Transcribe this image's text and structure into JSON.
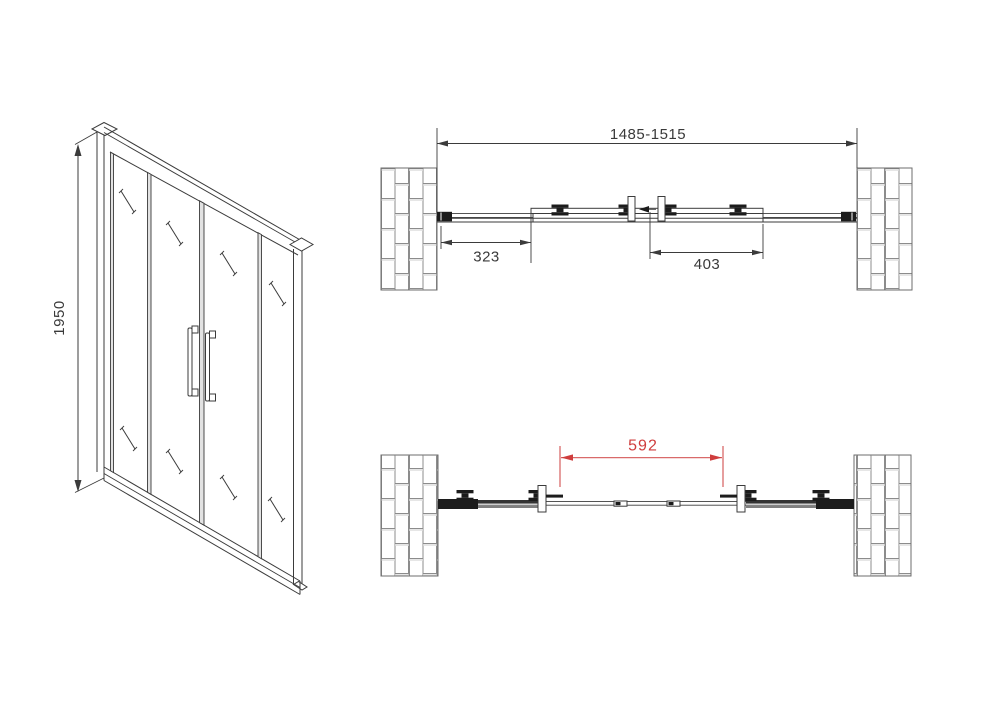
{
  "drawing": {
    "kind": "sliding-shower-door-technical-drawing",
    "views": [
      "front-perspective",
      "plan-closed",
      "plan-open"
    ]
  },
  "views": {
    "front": {
      "height_dim": "1950"
    },
    "plan_closed": {
      "overall_width_dim": "1485-1515",
      "left_panel_dim": "323",
      "door_panel_dim": "403"
    },
    "plan_open": {
      "opening_dim": "592"
    }
  },
  "colors": {
    "background": "#ffffff",
    "line": "#3b3b3b",
    "dark": "#1c1c1c",
    "text": "#3a3a3a",
    "brick_line": "#8c8c8c",
    "wall_outline": "#6e6e6e",
    "divider_fill": "#e2e2e2",
    "dim_red": "#cf3d3d",
    "dim_red_line": "#d96a6a"
  }
}
